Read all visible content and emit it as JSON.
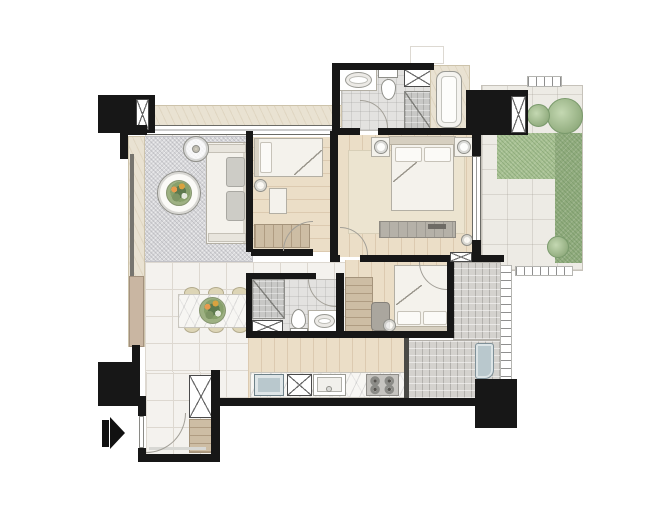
{
  "meta": {
    "kind": "apartment-floor-plan",
    "text_on_image": "none",
    "entry_arrow_direction": "right"
  },
  "palette": {
    "wall": "#171717",
    "tile": "#f4f2ee",
    "tile-line": "#ddd8d0",
    "bath-tile": "#e3e2e0",
    "wood": "#ebdec7",
    "wood-cab": "#cdbda4",
    "rug": "#d7d7da",
    "marble": "#e9e2d2",
    "pave": "#edebe5",
    "mosaic": "#d4d2ce",
    "green": "#a9c294",
    "green-dark": "#91ac7e",
    "furn": "#f4f2ec",
    "furn-line": "#b3afa4",
    "steel": "#b9c8cd",
    "arc": "#a29f97",
    "fixture-line": "#8f8f89"
  },
  "rooms": [
    {
      "name": "living-room",
      "features": [
        "area-rug",
        "sofa",
        "coffee-table-with-flowers",
        "floor-lamp",
        "window-wall-west"
      ]
    },
    {
      "name": "bedroom-2",
      "features": [
        "single-bed",
        "wardrobe",
        "desk",
        "table-lamp"
      ]
    },
    {
      "name": "master-bathroom",
      "features": [
        "vanity-sink",
        "toilet",
        "storage-cabinet",
        "shower",
        "bathtub-marble-deck"
      ]
    },
    {
      "name": "master-bedroom",
      "features": [
        "double-bed",
        "nightstand-lamp-left",
        "nightstand-lamp-right",
        "dresser",
        "rug",
        "window-east"
      ]
    },
    {
      "name": "garden-terrace",
      "features": [
        "paving-tiles",
        "lawn-l-shape",
        "tree",
        "shrubs",
        "hedge-strip",
        "railing-hatches"
      ]
    },
    {
      "name": "dining-area",
      "features": [
        "marble-dining-table",
        "six-chairs",
        "flower-centerpiece"
      ]
    },
    {
      "name": "bathroom-2",
      "features": [
        "shower",
        "toilet",
        "vanity-sink",
        "cabinet"
      ]
    },
    {
      "name": "bedroom-3",
      "features": [
        "bed-pillows-south",
        "chair",
        "wardrobe-column"
      ]
    },
    {
      "name": "utility-balcony",
      "features": [
        "mosaic-tile-floor",
        "washer-unit",
        "railing"
      ]
    },
    {
      "name": "kitchen",
      "features": [
        "refrigerator",
        "cabinet",
        "sink",
        "four-burner-stove",
        "marble-counter"
      ]
    },
    {
      "name": "entry",
      "features": [
        "door-swing",
        "shoe-cabinet",
        "entrance-arrow"
      ]
    }
  ],
  "structure": {
    "black_blocks": [
      "column-top-left",
      "column-top-right",
      "column-bottom-left",
      "column-bottom-right"
    ],
    "shafts_marked_x": 3,
    "door_arcs": 6
  }
}
